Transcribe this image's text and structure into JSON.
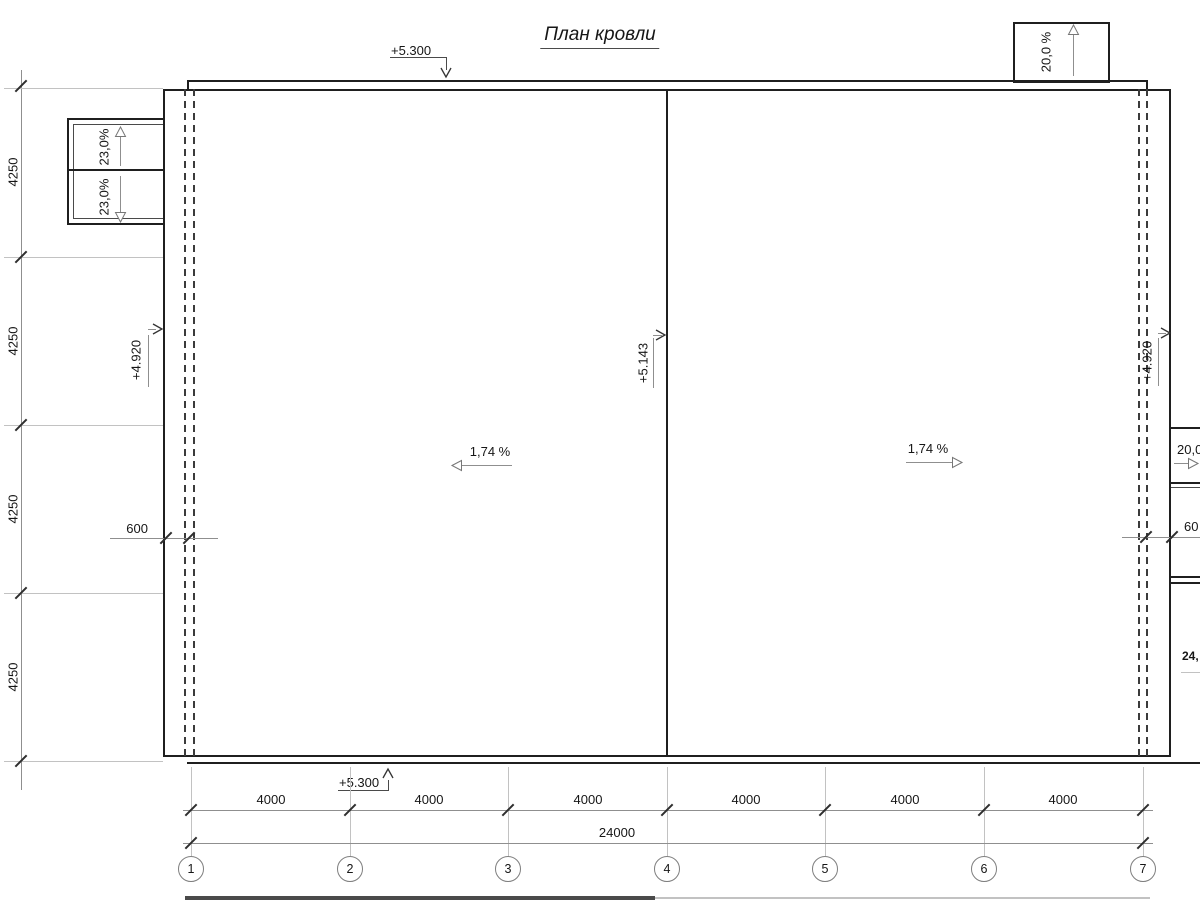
{
  "title": "План кровли",
  "roof": {
    "top_edge_elevation": "+5.300",
    "bottom_edge_elevation": "+5.300",
    "ridge_elevation": "+5.143",
    "left_eave_elevation": "+4.920",
    "right_eave_elevation": "+4.920",
    "left_slope": "1,74 %",
    "right_slope": "1,74 %"
  },
  "left_canopy": {
    "upper_slope": "23,0%",
    "lower_slope": "23,0%"
  },
  "top_canopy": {
    "slope": "20,0 %"
  },
  "right_annotations": {
    "slope": "20,0",
    "overhang_dim": "60",
    "ramp_slope": "24,"
  },
  "dimensions": {
    "left_column": [
      "4250",
      "4250",
      "4250",
      "4250"
    ],
    "bottom_bays": [
      "4000",
      "4000",
      "4000",
      "4000",
      "4000",
      "4000"
    ],
    "bottom_total": "24000",
    "left_overhang": "600"
  },
  "grid_bubbles": [
    "1",
    "2",
    "3",
    "4",
    "5",
    "6",
    "7"
  ],
  "colors": {
    "line": "#1f1f1f",
    "dim": "#8f8f8f",
    "extension": "#c2c2c2"
  }
}
